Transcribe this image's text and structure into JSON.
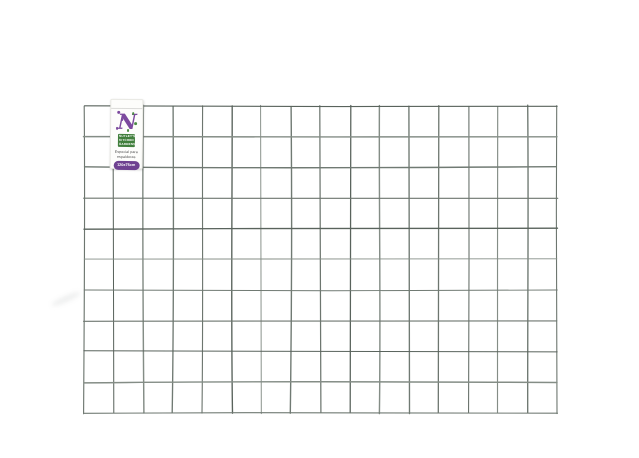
{
  "image": {
    "alt": "Green welded wire mesh panel on a white background with a small product tag at the top left",
    "background": "#ffffff"
  },
  "mesh": {
    "columns": 16,
    "rows": 10,
    "left": 84,
    "top": 106,
    "width": 473,
    "height": 307,
    "wire_shades": [
      "#6d766f",
      "#59635c",
      "#848d86",
      "#707a73"
    ]
  },
  "label": {
    "logo_letter": "N",
    "brand_text": "NUTLEY'S KITCHEN GARDENS",
    "tagline_line1": "Especial para",
    "tagline_line2": "espalderas",
    "badge_text": "120x75cm",
    "badge_color": "#6f4291",
    "logo_purple": "#7c4a9e",
    "logo_green": "#4c8c44",
    "brand_bg": "#417f3c",
    "tagline_color": "#4a4a4a"
  }
}
